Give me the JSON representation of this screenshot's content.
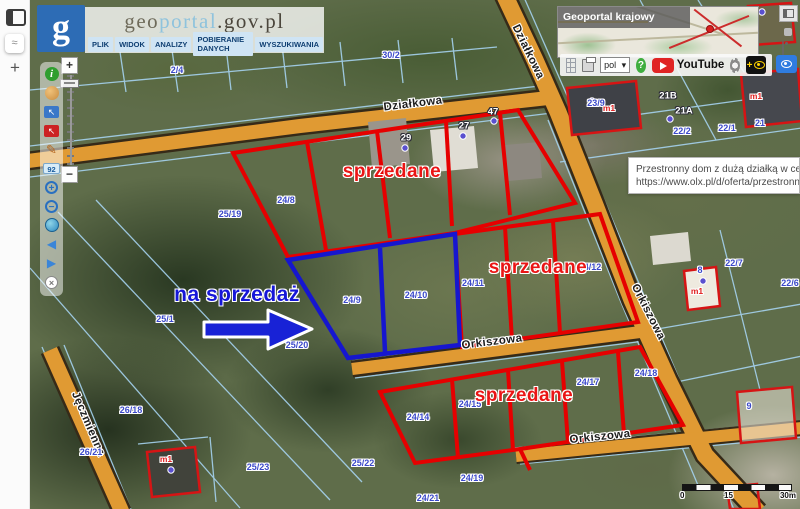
{
  "browser_rail": {
    "new_tab": "+"
  },
  "header": {
    "logo_letter": "g",
    "title": {
      "geo": "geo",
      "portal": "portal",
      "suffix": ".gov.pl"
    },
    "menu": [
      {
        "t": "PLIK"
      },
      {
        "t": "WIDOK"
      },
      {
        "t": "ANALIZY"
      },
      {
        "t": "POBIERANIE DANYCH"
      },
      {
        "t": "WYSZUKIWANIA"
      }
    ]
  },
  "minimap": {
    "label": "Geoportal krajowy"
  },
  "topbar": {
    "language": "pol",
    "chevron": "▾",
    "help": "?",
    "youtube": "YouTube",
    "contrast_plus": "+"
  },
  "tooltip": {
    "line1": "Przestronny dom z dużą działką w centrum K",
    "line2": "https://www.olx.pl/d/oferta/przestronny-dom-"
  },
  "tools": {
    "info": "i",
    "select_arrow": "↖",
    "measure": "✎",
    "coords": "92",
    "zoom_in": "+",
    "zoom_out": "−",
    "prev": "◀",
    "next": "▶",
    "reset": "×"
  },
  "zoom_slider": {
    "plus": "+",
    "minus": "−"
  },
  "annotations": {
    "for_sale": [
      {
        "t": "na sprzedaż",
        "x": 237,
        "y": 295
      }
    ],
    "sold": [
      {
        "t": "sprzedane",
        "x": 392,
        "y": 172
      },
      {
        "t": "sprzedane",
        "x": 538,
        "y": 268
      },
      {
        "t": "sprzedane",
        "x": 524,
        "y": 396
      }
    ]
  },
  "streets": [
    {
      "t": "Działkowa",
      "x": 413,
      "y": 104,
      "rot": -7
    },
    {
      "t": "Działkowa",
      "x": 528,
      "y": 52,
      "rot": 64
    },
    {
      "t": "Orkiszowa",
      "x": 492,
      "y": 342,
      "rot": -7
    },
    {
      "t": "Orkiszowa",
      "x": 648,
      "y": 312,
      "rot": 63
    },
    {
      "t": "Orkiszowa",
      "x": 600,
      "y": 437,
      "rot": -6
    },
    {
      "t": "Jęczmienna",
      "x": 88,
      "y": 424,
      "rot": 67
    }
  ],
  "parcel_labels": [
    {
      "t": "25/19",
      "x": 230,
      "y": 214
    },
    {
      "t": "25/1",
      "x": 165,
      "y": 319
    },
    {
      "t": "25/20",
      "x": 297,
      "y": 345
    },
    {
      "t": "24/8",
      "x": 286,
      "y": 200
    },
    {
      "t": "24/9",
      "x": 352,
      "y": 300
    },
    {
      "t": "24/10",
      "x": 416,
      "y": 295
    },
    {
      "t": "24/11",
      "x": 473,
      "y": 283
    },
    {
      "t": "24/12",
      "x": 590,
      "y": 267
    },
    {
      "t": "24/14",
      "x": 418,
      "y": 417
    },
    {
      "t": "24/15",
      "x": 470,
      "y": 404
    },
    {
      "t": "24/17",
      "x": 588,
      "y": 382
    },
    {
      "t": "24/18",
      "x": 646,
      "y": 373
    },
    {
      "t": "24/19",
      "x": 472,
      "y": 478
    },
    {
      "t": "24/21",
      "x": 428,
      "y": 498
    },
    {
      "t": "25/22",
      "x": 363,
      "y": 463
    },
    {
      "t": "25/23",
      "x": 258,
      "y": 467
    },
    {
      "t": "26/21",
      "x": 91,
      "y": 452
    },
    {
      "t": "26/18",
      "x": 131,
      "y": 410
    },
    {
      "t": "23/9",
      "x": 596,
      "y": 103
    },
    {
      "t": "22/1",
      "x": 727,
      "y": 128
    },
    {
      "t": "22/2",
      "x": 682,
      "y": 131
    },
    {
      "t": "22/7",
      "x": 734,
      "y": 263
    },
    {
      "t": "22/6",
      "x": 790,
      "y": 283
    },
    {
      "t": "21",
      "x": 760,
      "y": 123
    },
    {
      "t": "9",
      "x": 749,
      "y": 406
    },
    {
      "t": "8",
      "x": 700,
      "y": 270
    },
    {
      "t": "30/2",
      "x": 391,
      "y": 55
    },
    {
      "t": "2/4",
      "x": 177,
      "y": 70
    }
  ],
  "address_labels": [
    {
      "t": "29",
      "x": 406,
      "y": 138
    },
    {
      "t": "27",
      "x": 464,
      "y": 126
    },
    {
      "t": "47",
      "x": 493,
      "y": 112
    },
    {
      "t": "21B",
      "x": 668,
      "y": 96
    },
    {
      "t": "21A",
      "x": 684,
      "y": 111
    }
  ],
  "building_labels": [
    {
      "t": "m1",
      "x": 609,
      "y": 108
    },
    {
      "t": "m1",
      "x": 756,
      "y": 96
    },
    {
      "t": "m1",
      "x": 697,
      "y": 291
    },
    {
      "t": "m1",
      "x": 166,
      "y": 459
    }
  ],
  "scalebar": {
    "zero": "0",
    "mid": "15",
    "end": "30m"
  },
  "colors": {
    "sold": "#e60000",
    "for_sale": "#1616cf",
    "road": "#e09a33",
    "cadastral": "#a5d2ef",
    "label_blue": "#3b49c9"
  }
}
